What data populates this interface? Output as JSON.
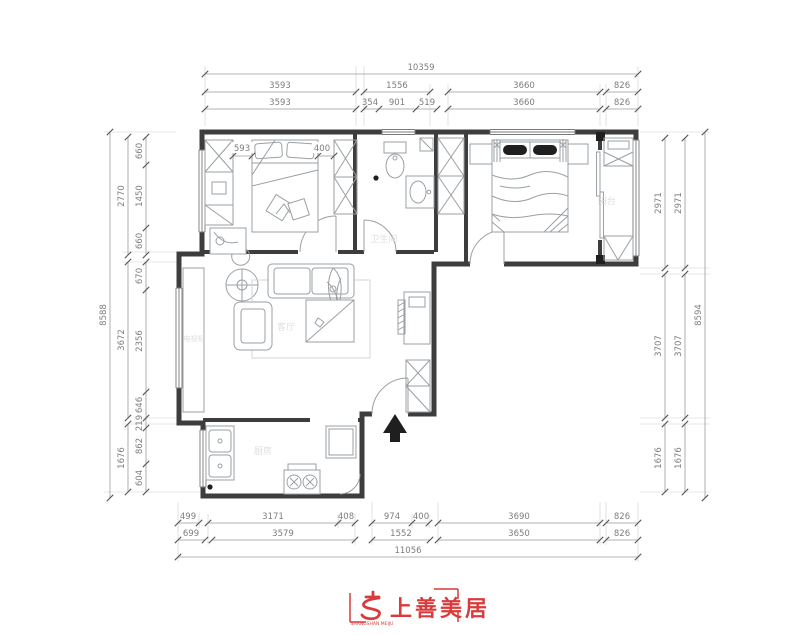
{
  "rooms": {
    "bathroom": "卫生间",
    "balcony": "阳台",
    "kitchen": "厨房",
    "living": "客厅",
    "tv_cabinet": "电视柜"
  },
  "dims": {
    "top": {
      "total": "10359",
      "row2": [
        "3593",
        "1556",
        "3660",
        "826"
      ],
      "row3": [
        "3593",
        "354",
        "901",
        "519",
        "3660",
        "826"
      ]
    },
    "bottom": {
      "row1": [
        "499",
        "3171",
        "408",
        "974",
        "400",
        "3690",
        "826"
      ],
      "row2": [
        "699",
        "3579",
        "1552",
        "3650",
        "826"
      ],
      "total": "11056"
    },
    "left": {
      "total": "8588",
      "mid": [
        "2770",
        "3672",
        "1676"
      ],
      "inner": [
        "660",
        "1450",
        "660",
        "670",
        "2356",
        "646",
        "219",
        "862",
        "604"
      ]
    },
    "right": {
      "col1": [
        "2971",
        "3707",
        "1676"
      ],
      "col2": [
        "2971",
        "3707",
        "1676"
      ],
      "total": "8594"
    },
    "inplan": {
      "wardrobe": "593",
      "gap": "400"
    }
  },
  "logo": {
    "name": "上善美居",
    "sub": "SHANGSHAN MEIJU",
    "color": "#d93a3b"
  }
}
